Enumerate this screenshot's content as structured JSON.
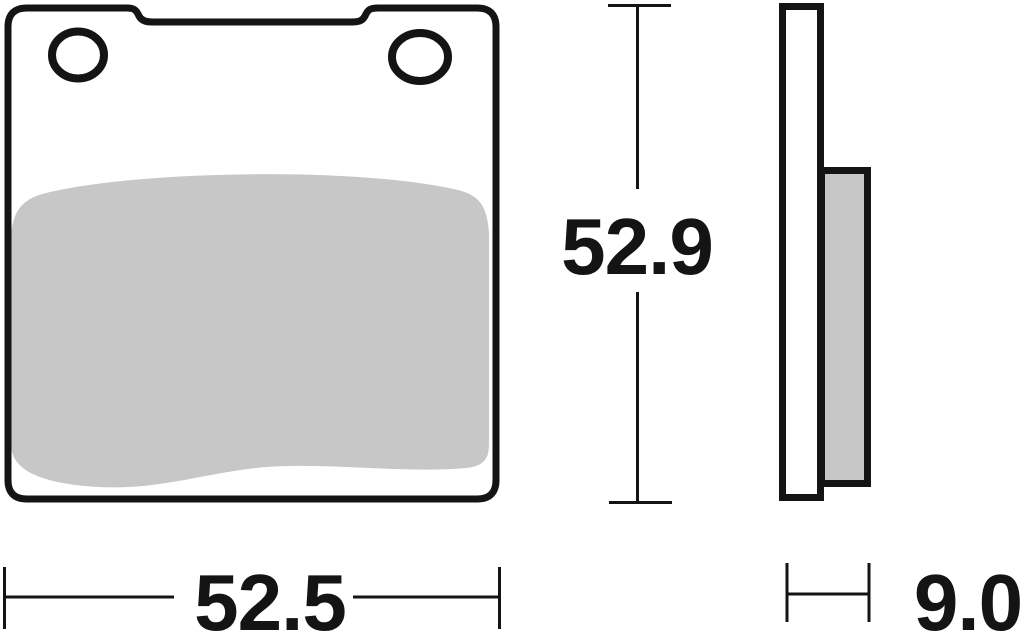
{
  "drawing": {
    "subject": "brake-pad",
    "views": [
      "front",
      "side"
    ]
  },
  "colors": {
    "line": "#141414",
    "friction": "#c7c7c7",
    "plate_fill": "#ffffff",
    "background": "#ffffff"
  },
  "dimensions": {
    "height": "52.9",
    "width": "52.5",
    "thickness": "9.0"
  }
}
